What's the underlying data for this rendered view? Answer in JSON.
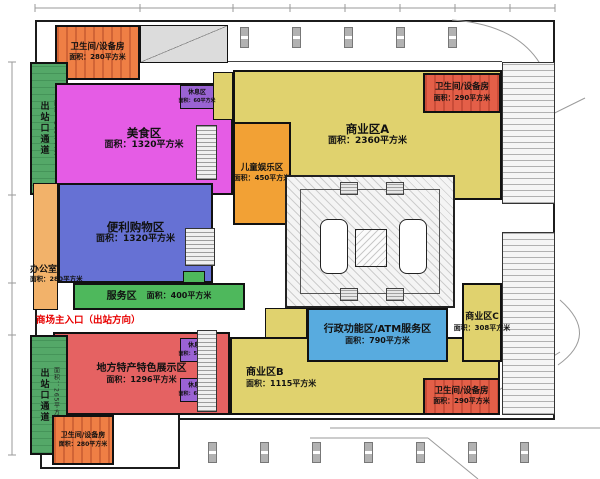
{
  "plan": {
    "entrance_note": "商场主入口（出站方向）",
    "zones": {
      "wc_top_left": {
        "name": "卫生间/设备房",
        "area": "面积：280平方米"
      },
      "exit_top": {
        "name": "出站口通道",
        "area": "面积：265平方米"
      },
      "food": {
        "name": "美食区",
        "area": "面积：1320平方米"
      },
      "rest_60": {
        "name": "休息区",
        "area": "面积：60平方米"
      },
      "commercial_a": {
        "name": "商业区A",
        "area": "面积：2360平方米"
      },
      "kids": {
        "name": "儿童娱乐区",
        "area": "面积：450平方米"
      },
      "wc_top_right": {
        "name": "卫生间/设备房",
        "area": "面积：290平方米"
      },
      "office": {
        "name": "办公室",
        "area": "面积：280平方米"
      },
      "convenience": {
        "name": "便利购物区",
        "area": "面积：1320平方米"
      },
      "service": {
        "name": "服务区",
        "area": "面积：400平方米"
      },
      "local": {
        "name": "地方特产特色展示区",
        "area": "面积：1296平方米"
      },
      "rest_53": {
        "name": "休息区",
        "area": "面积：53平方米"
      },
      "rest_66": {
        "name": "休息区",
        "area": "面积：66平方米"
      },
      "exit_bottom": {
        "name": "出站口通道",
        "area": "面积：265平方米"
      },
      "wc_bottom_left": {
        "name": "卫生间/设备房",
        "area": "面积：280平方米"
      },
      "commercial_b": {
        "name": "商业区B",
        "area": "面积：1115平方米"
      },
      "admin_atm": {
        "name": "行政功能区/ATM服务区",
        "area": "面积：790平方米"
      },
      "commercial_c": {
        "name": "商业区C",
        "area": "面积：308平方米"
      },
      "wc_bottom_right": {
        "name": "卫生间/设备房",
        "area": "面积：290平方米"
      }
    },
    "colors": {
      "food": "#e55ce5",
      "commercial": "#e0d26e",
      "kids": "#f2a135",
      "wc_orange": "#ef7f45",
      "wc_red": "#e45f48",
      "convenience": "#6671d4",
      "service": "#4eb85c",
      "exit_corridor": "#54a868",
      "office": "#f2b26a",
      "local_products": "#e56262",
      "admin_atm": "#58abdf",
      "rest": "#9a63d3",
      "entrance_text": "#e80000"
    }
  }
}
